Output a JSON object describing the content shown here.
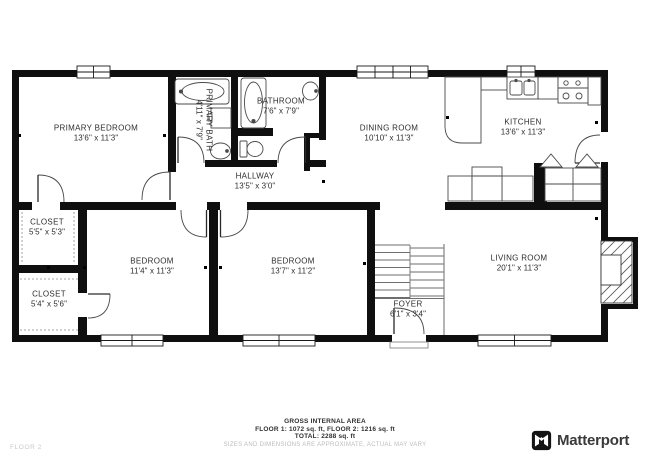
{
  "plan": {
    "rooms": [
      {
        "name": "PRIMARY BEDROOM",
        "dims": "13'6\" x 11'3\""
      },
      {
        "name": "PRIMARY BATH",
        "dims": "4'11\" x 7'9\""
      },
      {
        "name": "BATHROOM",
        "dims": "7'6\" x 7'9\""
      },
      {
        "name": "DINING ROOM",
        "dims": "10'10\" x 11'3\""
      },
      {
        "name": "KITCHEN",
        "dims": "13'6\" x 11'3\""
      },
      {
        "name": "HALLWAY",
        "dims": "13'5\" x 3'0\""
      },
      {
        "name": "CLOSET",
        "dims": "5'5\" x 5'3\""
      },
      {
        "name": "CLOSET",
        "dims": "5'4\" x 5'6\""
      },
      {
        "name": "BEDROOM",
        "dims": "11'4\" x 11'3\""
      },
      {
        "name": "BEDROOM",
        "dims": "13'7\" x 11'2\""
      },
      {
        "name": "FOYER",
        "dims": "6'1\" x 3'4\""
      },
      {
        "name": "LIVING ROOM",
        "dims": "20'1\" x 11'3\""
      }
    ]
  },
  "footer": {
    "area_title": "GROSS INTERNAL AREA",
    "area_line1": "FLOOR 1: 1072 sq. ft, FLOOR 2: 1216 sq. ft",
    "area_line2": "TOTAL: 2288 sq. ft",
    "disclaimer": "SIZES AND DIMENSIONS ARE APPROXIMATE, ACTUAL MAY VARY",
    "floor_label": "FLOOR 2",
    "brand": "Matterport"
  },
  "colors": {
    "wall": "#0f0f0f",
    "fixture_line": "#4a4a4a",
    "label_text": "#2e2e2e",
    "muted_text": "#bcbcbc"
  }
}
